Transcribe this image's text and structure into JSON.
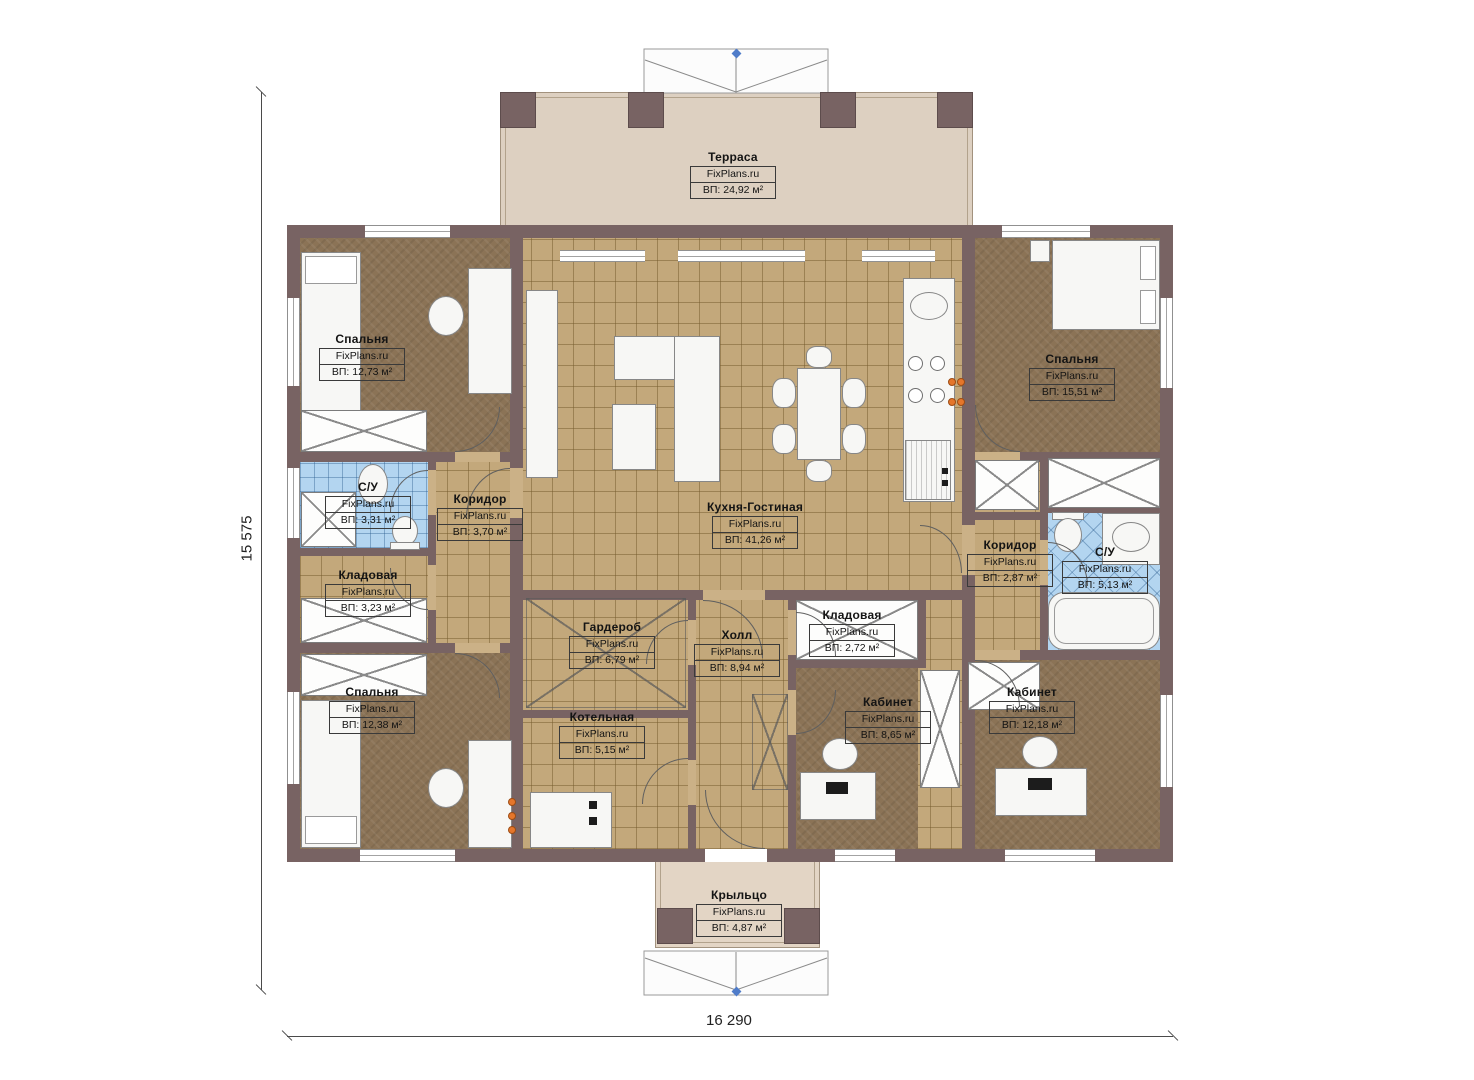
{
  "page": {
    "type": "architectural-floor-plan",
    "background": "#ffffff"
  },
  "watermark": "FixPlans.ru",
  "dimensions": {
    "horizontal": "16 290",
    "vertical": "15 575"
  },
  "rooms": [
    {
      "name": "Терраса",
      "watermark": "FixPlans.ru",
      "area": "ВП: 24,92 м²"
    },
    {
      "name": "Спальня",
      "watermark": "FixPlans.ru",
      "area": "ВП: 12,73 м²"
    },
    {
      "name": "Спальня",
      "watermark": "FixPlans.ru",
      "area": "ВП: 15,51 м²"
    },
    {
      "name": "С/У",
      "watermark": "FixPlans.ru",
      "area": "ВП: 3,31 м²"
    },
    {
      "name": "Коридор",
      "watermark": "FixPlans.ru",
      "area": "ВП: 3,70 м²"
    },
    {
      "name": "Кухня-Гостиная",
      "watermark": "FixPlans.ru",
      "area": "ВП: 41,26 м²"
    },
    {
      "name": "Кладовая",
      "watermark": "FixPlans.ru",
      "area": "ВП: 3,23 м²"
    },
    {
      "name": "Коридор",
      "watermark": "FixPlans.ru",
      "area": "ВП: 2,87 м²"
    },
    {
      "name": "С/У",
      "watermark": "FixPlans.ru",
      "area": "ВП: 5,13 м²"
    },
    {
      "name": "Гардероб",
      "watermark": "FixPlans.ru",
      "area": "ВП: 6,79 м²"
    },
    {
      "name": "Холл",
      "watermark": "FixPlans.ru",
      "area": "ВП: 8,94 м²"
    },
    {
      "name": "Кладовая",
      "watermark": "FixPlans.ru",
      "area": "ВП: 2,72 м²"
    },
    {
      "name": "Спальня",
      "watermark": "FixPlans.ru",
      "area": "ВП: 12,38 м²"
    },
    {
      "name": "Котельная",
      "watermark": "FixPlans.ru",
      "area": "ВП: 5,15 м²"
    },
    {
      "name": "Кабинет",
      "watermark": "FixPlans.ru",
      "area": "ВП: 8,65 м²"
    },
    {
      "name": "Кабинет",
      "watermark": "FixPlans.ru",
      "area": "ВП: 12,18 м²"
    },
    {
      "name": "Крыльцо",
      "watermark": "FixPlans.ru",
      "area": "ВП: 4,87 м²"
    }
  ],
  "colors": {
    "wall": "#786363",
    "floor_tile": "#c3a87b",
    "carpet": "#8b7356",
    "bath_tile": "#b3d5f0",
    "terrace": "#ddd0c1",
    "burner_orange": "#e5762b",
    "dimension_line": "#4a4a4a",
    "roof_marker_blue": "#4f7cc9"
  }
}
